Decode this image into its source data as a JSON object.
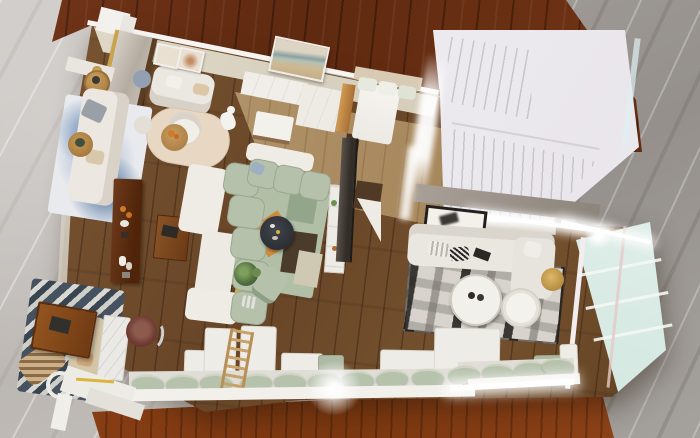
{
  "scene": {
    "type": "3d-interior-render",
    "view": "top-down bird's-eye perspective",
    "description": "Photorealistic top-down render of a furnished open-plan loft apartment model standing on a reddish-brown wooden table over gray marble flooring",
    "rooms": [
      {
        "name": "entry-lounge",
        "items": [
          "marble entry cabinet with gold trim",
          "white wall console",
          "gold table lamp",
          "round wood side tables",
          "white sofa on blue abstract rug",
          "white loveseat",
          "two small framed prints",
          "round beige rug",
          "white round lounge chair",
          "round wood coffee table with orange flowers",
          "white dog sculpture"
        ]
      },
      {
        "name": "dining-kitchen",
        "items": [
          "framed landscape painting",
          "white cabinet row",
          "white ottoman",
          "wood pillar",
          "light wood floor"
        ]
      },
      {
        "name": "bedroom-nook",
        "items": [
          "bed with sage and white pillows",
          "tan headboard",
          "dark wardrobe strip"
        ]
      },
      {
        "name": "staircase",
        "items": [
          "white switchback staircase",
          "upper tread flight",
          "lower tread flight",
          "landing"
        ]
      },
      {
        "name": "living-room",
        "items": [
          "sage green modular sofa with white shell",
          "geometric rug in sage orange brown yellow",
          "round dark coffee table",
          "potted plant",
          "small sage armchair",
          "white ladder shelf",
          "flat tv panel",
          "dark wood console with decor",
          "wood writing desk"
        ]
      },
      {
        "name": "media-lounge",
        "items": [
          "gray feature wall with led strip",
          "black framed leaning artwork",
          "white sectional sofa with chaise",
          "patchwork cowhide rug",
          "two round white coffee tables",
          "gold stool",
          "pale green glass wall"
        ]
      },
      {
        "name": "reading-corner",
        "items": [
          "navy striped rug",
          "tan sofa",
          "rich wood coffee table with book",
          "rattan lounge chair",
          "white ring decor",
          "marble side table",
          "maroon swivel chair"
        ]
      },
      {
        "name": "window-bench",
        "items": [
          "white back panels",
          "sage seat cushions",
          "wooden ladder",
          "white ledge",
          "sunlight flares"
        ]
      }
    ],
    "palette": {
      "marble_left": "#c6c2be",
      "marble_right": "#a29e9b",
      "table_wood": "#6e3415",
      "table_wood_bright": "#8c3f16",
      "floor_wood": "#6f4e2d",
      "floor_wood_light": "#b49a6f",
      "wall_beige": "#ddd5c4",
      "wall_white": "#f3f1ed",
      "stair_white": "#f2f0f3",
      "sofa_white": "#ebe7e1",
      "sofa_sage": "#b6c1ac",
      "sofa_tan": "#d5c6a7",
      "rug_blue": "#8ea6c6",
      "rug_navy": "#46525f",
      "rug_beige": "#e7d7c3",
      "rug_sage": "#b0bfa6",
      "rug_orange": "#cd8d3f",
      "rug_yellow": "#d2ae48",
      "rug_patchwork_dark": "#2b2927",
      "glass_pane": "#d6e9e3",
      "gold_accent": "#c89a3e",
      "maroon_chair": "#6f3b32",
      "tv_dark": "#332d28"
    }
  }
}
